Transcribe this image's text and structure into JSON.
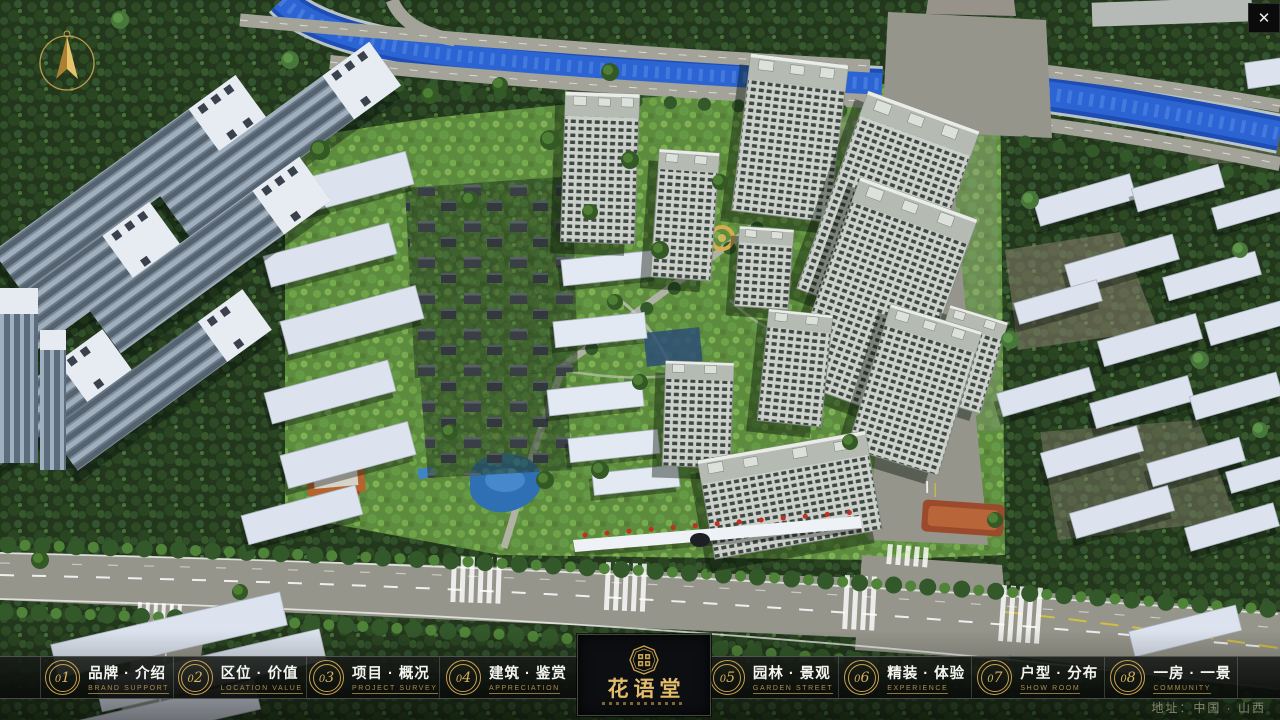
{
  "window": {
    "close_icon": "✕"
  },
  "nav": {
    "items": [
      {
        "num": "01",
        "zh": "品牌 · 介绍",
        "en": "BRAND SUPPORT"
      },
      {
        "num": "02",
        "zh": "区位 · 价值",
        "en": "LOCATION VALUE"
      },
      {
        "num": "03",
        "zh": "项目 · 概况",
        "en": "PROJECT SURVEY"
      },
      {
        "num": "04",
        "zh": "建筑 · 鉴赏",
        "en": "APPRECIATION"
      },
      {
        "num": "05",
        "zh": "园林 · 景观",
        "en": "GARDEN STREET"
      },
      {
        "num": "06",
        "zh": "精装 · 体验",
        "en": "EXPERIENCE"
      },
      {
        "num": "07",
        "zh": "户型 · 分布",
        "en": "SHOW ROOM"
      },
      {
        "num": "08",
        "zh": "一房 · 一景",
        "en": "COMMUNITY"
      }
    ],
    "logo": {
      "title": "花语堂"
    }
  },
  "footer": {
    "address": "地址：中国 · 山西"
  }
}
